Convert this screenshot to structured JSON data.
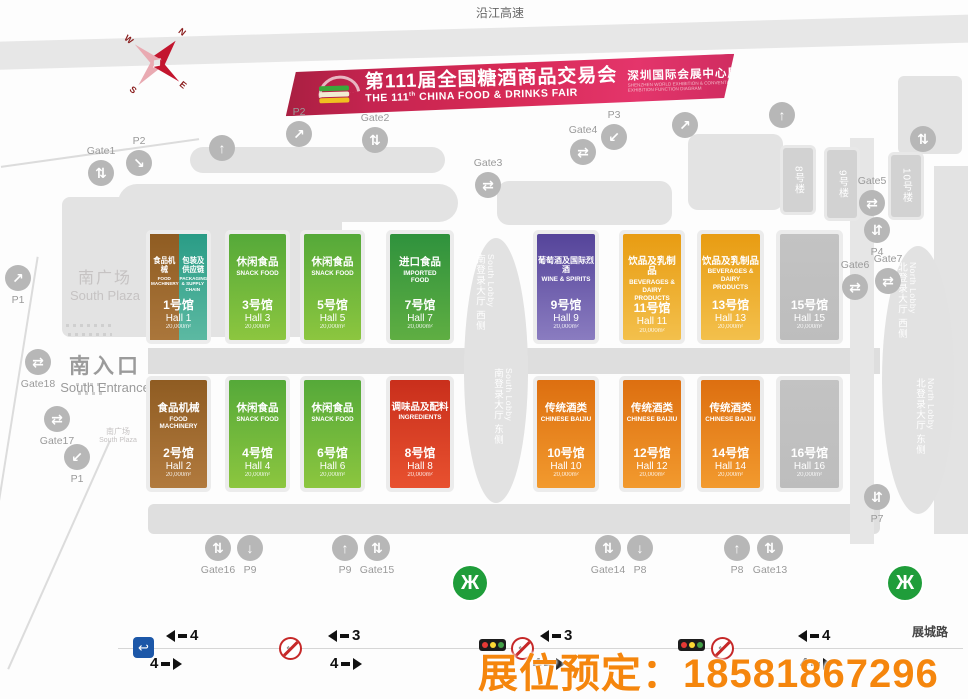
{
  "banner": {
    "title_cn": "第111届全国糖酒商品交易会",
    "title_en_pre": "THE 111",
    "title_en_sup": "th",
    "title_en_post": "CHINA FOOD & DRINKS FAIR",
    "right_cn": "深圳国际会展中心展区功能图",
    "right_en1": "SHENZHEN WORLD EXHIBITION & CONVENTION CENTER",
    "right_en2": "EXHIBITION FUNCTION DIAGRAM"
  },
  "compass": {
    "n": "N",
    "e": "E",
    "s": "S",
    "w": "W"
  },
  "labels": {
    "expressway": "沿江高速",
    "south_plaza_cn": "南广场",
    "south_plaza_en": "South Plaza",
    "south_entrance_cn": "南入口",
    "south_entrance_en": "South Entrance",
    "south_plaza_small_cn": "南广场",
    "south_plaza_small_en": "South Plaza",
    "road_bottom": "展城路",
    "booking": "展位预定：18581867296"
  },
  "lobbies": {
    "south_west_cn": "南登录大厅 西侧",
    "south_west_en": "South Lobby",
    "south_east_cn": "南登录大厅 东侧",
    "south_east_en": "South Lobby",
    "north_west_cn": "北登录大厅 西侧",
    "north_west_en": "North Lobby",
    "north_east_cn": "北登录大厅 东侧",
    "north_east_en": "North Lobby"
  },
  "buildings": {
    "b8": "8号楼",
    "b9": "9号楼",
    "b10": "10号楼"
  },
  "halls": [
    {
      "num": "1号馆",
      "name": "Hall 1",
      "area": "20,000m²",
      "catA": "食品机械",
      "catA_en": "FOOD MACHINERY",
      "catB": "包装及供应链",
      "catB_en": "PACKAGING & SUPPLY CHAIN"
    },
    {
      "cat": "休闲食品",
      "cat_en": "SNACK FOOD",
      "num": "3号馆",
      "name": "Hall 3",
      "area": "20,000m²"
    },
    {
      "cat": "休闲食品",
      "cat_en": "SNACK FOOD",
      "num": "5号馆",
      "name": "Hall 5",
      "area": "20,000m²"
    },
    {
      "cat": "进口食品",
      "cat_en": "IMPORTED FOOD",
      "num": "7号馆",
      "name": "Hall 7",
      "area": "20,000m²"
    },
    {
      "cat": "葡萄酒及国际烈酒",
      "cat_en": "WINE & SPIRITS",
      "num": "9号馆",
      "name": "Hall 9",
      "area": "20,000m²"
    },
    {
      "cat": "饮品及乳制品",
      "cat_en": "BEVERAGES & DAIRY PRODUCTS",
      "num": "11号馆",
      "name": "Hall 11",
      "area": "20,000m²"
    },
    {
      "cat": "饮品及乳制品",
      "cat_en": "BEVERAGES & DAIRY PRODUCTS",
      "num": "13号馆",
      "name": "Hall 13",
      "area": "20,000m²"
    },
    {
      "cat": "",
      "cat_en": "",
      "num": "15号馆",
      "name": "Hall 15",
      "area": "20,000m²"
    },
    {
      "cat": "食品机械",
      "cat_en": "FOOD MACHINERY",
      "num": "2号馆",
      "name": "Hall 2",
      "area": "20,000m²"
    },
    {
      "cat": "休闲食品",
      "cat_en": "SNACK FOOD",
      "num": "4号馆",
      "name": "Hall 4",
      "area": "20,000m²"
    },
    {
      "cat": "休闲食品",
      "cat_en": "SNACK FOOD",
      "num": "6号馆",
      "name": "Hall 6",
      "area": "20,000m²"
    },
    {
      "cat": "调味品及配料",
      "cat_en": "INGREDIENTS",
      "num": "8号馆",
      "name": "Hall 8",
      "area": "20,000m²"
    },
    {
      "cat": "传统酒类",
      "cat_en": "CHINESE BAIJIU",
      "num": "10号馆",
      "name": "Hall 10",
      "area": "20,000m²"
    },
    {
      "cat": "传统酒类",
      "cat_en": "CHINESE BAIJIU",
      "num": "12号馆",
      "name": "Hall 12",
      "area": "20,000m²"
    },
    {
      "cat": "传统酒类",
      "cat_en": "CHINESE BAIJIU",
      "num": "14号馆",
      "name": "Hall 14",
      "area": "20,000m²"
    },
    {
      "cat": "",
      "cat_en": "",
      "num": "16号馆",
      "name": "Hall 16",
      "area": "20,000m²"
    }
  ],
  "markers": [
    "Gate1",
    "P2",
    "P2",
    "Gate2",
    "Gate3",
    "Gate4",
    "P3",
    "Gate5",
    "P4",
    "Gate6",
    "Gate7",
    "P7",
    "Gate18",
    "P1",
    "Gate17",
    "P1",
    "Gate16",
    "P9",
    "P9",
    "Gate15",
    "Gate14",
    "P8",
    "P8",
    "Gate13"
  ],
  "icons": {
    "updown": "⇅",
    "up": "↑",
    "down": "↓",
    "diag_ne": "↗",
    "diag_se": "↘",
    "diag_sw": "↙",
    "swap": "⇄",
    "swap_v": "⇵",
    "metro": "Ж",
    "uturn": "↩"
  },
  "traffic": {
    "lanes": [
      {
        "left": "4",
        "right": "4"
      },
      {
        "left": "3",
        "right": "4"
      },
      {
        "left": "3",
        "right": "4"
      },
      {
        "left": "4",
        "right": "4"
      }
    ]
  }
}
